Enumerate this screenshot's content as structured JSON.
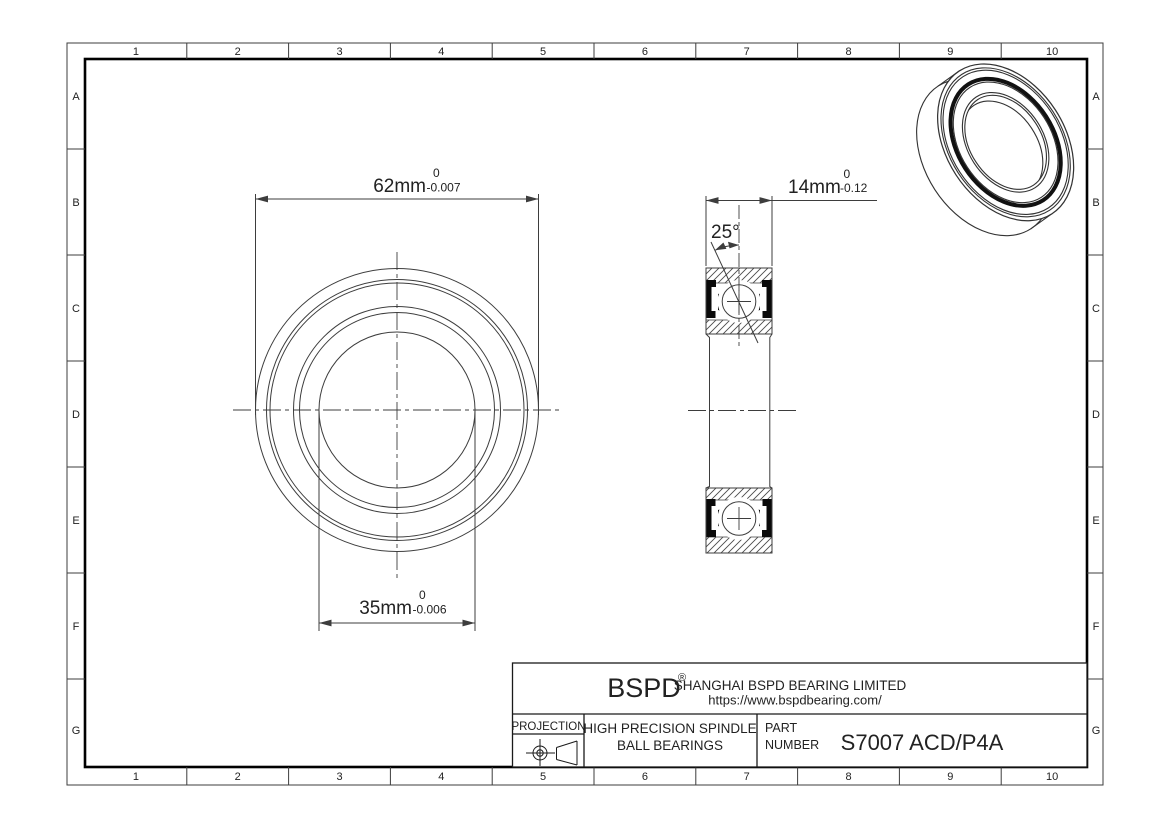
{
  "frame": {
    "columns": [
      "1",
      "2",
      "3",
      "4",
      "5",
      "6",
      "7",
      "8",
      "9",
      "10"
    ],
    "rows": [
      "A",
      "B",
      "C",
      "D",
      "E",
      "F",
      "G"
    ]
  },
  "dimensions": {
    "outer_diameter": {
      "value": "62mm",
      "tolerance_upper": "0",
      "tolerance_lower": "-0.007"
    },
    "bore_diameter": {
      "value": "35mm",
      "tolerance_upper": "0",
      "tolerance_lower": "-0.006"
    },
    "width": {
      "value": "14mm",
      "tolerance_upper": "0",
      "tolerance_lower": "-0.12"
    },
    "contact_angle": {
      "value": "25°"
    }
  },
  "title_block": {
    "logo": "BSPD",
    "logo_reg": "®",
    "company": "SHANGHAI BSPD BEARING LIMITED",
    "website": "https://www.bspdbearing.com/",
    "projection_label": "PROJECTION",
    "product_line1": "HIGH  PRECISION SPINDLE",
    "product_line2": "BALL BEARINGS",
    "part_label_line1": "PART",
    "part_label_line2": "NUMBER",
    "part_number": "S7007 ACD/P4A"
  }
}
